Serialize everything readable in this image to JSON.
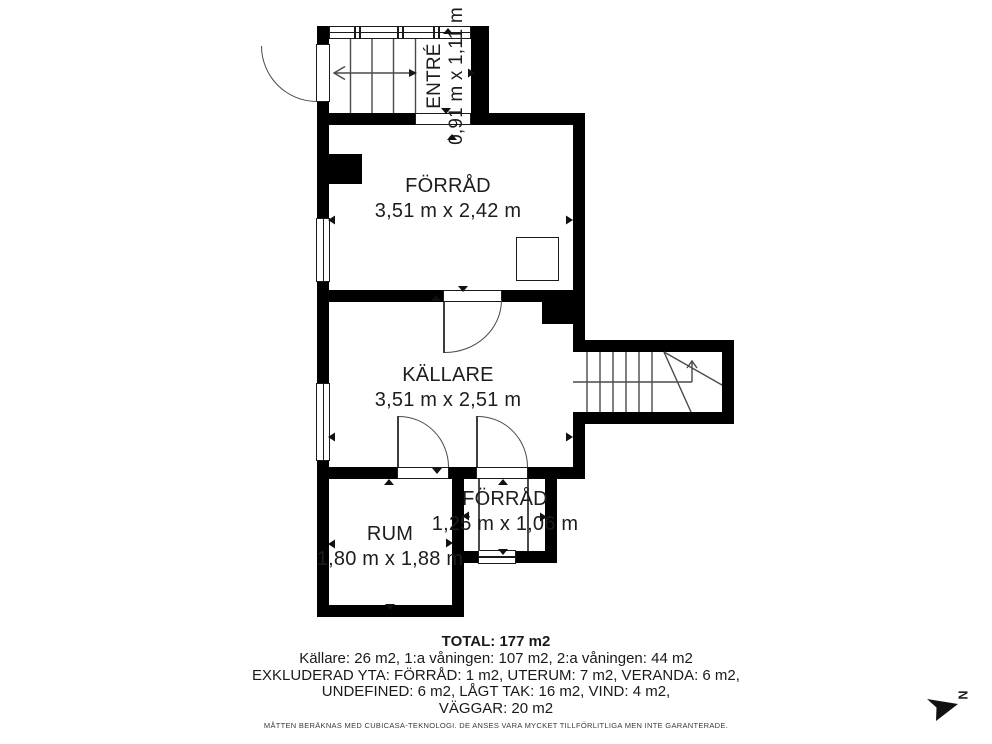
{
  "plan": {
    "rooms": [
      {
        "name": "ENTRÉ",
        "dims": "0,91 m x 1,11 m"
      },
      {
        "name": "FÖRRÅD",
        "dims": "3,51 m x 2,42 m"
      },
      {
        "name": "KÄLLARE",
        "dims": "3,51 m x 2,51 m"
      },
      {
        "name": "FÖRRÅD",
        "dims": "1,25 m x 1,06 m"
      },
      {
        "name": "RUM",
        "dims": "1,80 m x 1,88 m"
      }
    ],
    "compass_label": "N"
  },
  "summary": {
    "total": "TOTAL: 177 m2",
    "lines": [
      "Källare: 26 m2, 1:a våningen: 107 m2, 2:a våningen: 44 m2",
      "EXKLUDERAD YTA: FÖRRÅD: 1 m2, UTERUM: 7 m2, VERANDA: 6 m2,",
      "UNDEFINED: 6 m2, LÅGT TAK: 16 m2, VIND: 4 m2,",
      "VÄGGAR: 20 m2"
    ],
    "disclaimer": "MÅTTEN BERÄKNAS MED CUBICASA-TEKNOLOGI. DE ANSES VARA MYCKET TILLFÖRLITLIGA MEN INTE GARANTERADE."
  },
  "colors": {
    "wall": "#000000",
    "line": "#4a4a4a",
    "text": "#1d1d1f"
  }
}
